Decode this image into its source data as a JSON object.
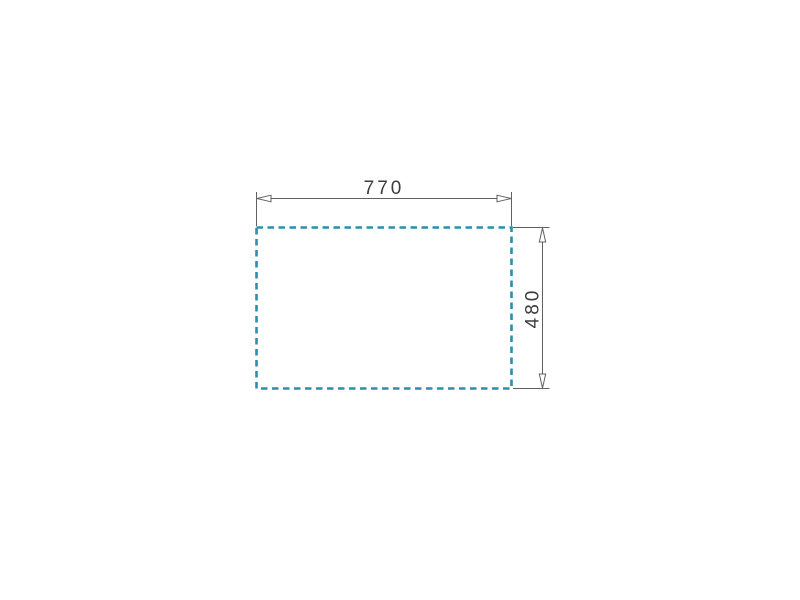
{
  "page": {
    "background_color": "#ffffff"
  },
  "drawing": {
    "type": "cutout-dimension-diagram",
    "outline_color": "#2d8daf",
    "line_color": "#606060",
    "text_color": "#3d3d3d",
    "arrowhead_fill": "#ffffff",
    "width_dimension": {
      "label": "770"
    },
    "height_dimension": {
      "label": "480"
    }
  }
}
